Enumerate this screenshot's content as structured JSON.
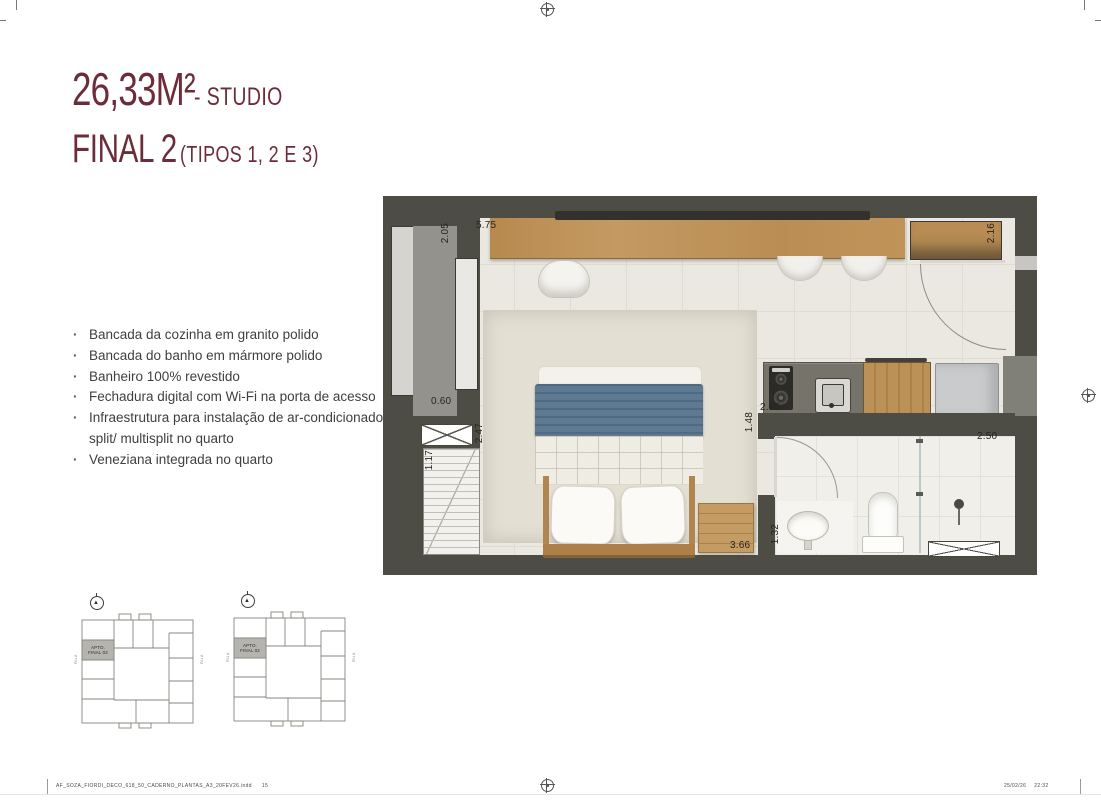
{
  "header": {
    "area": "26,33M²",
    "area_suffix": "- STUDIO",
    "unit": "FINAL 2",
    "unit_suffix": "(TIPOS 1, 2 E 3)",
    "accent_color": "#6d2c3a"
  },
  "features": [
    "Bancada da cozinha em granito polido",
    "Bancada do banho em mármore polido",
    "Banheiro 100% revestido",
    "Fechadura digital com Wi-Fi na porta de acesso",
    "Infraestrutura para instalação de ar-condicionado tipo split/ multisplit no quarto",
    "Veneziana integrada no quarto"
  ],
  "floorplan": {
    "wall_color": "#4e4d45",
    "wood_color": "#b98d54",
    "blanket_color": "#5e7a92",
    "dims": {
      "desk_width": "5.75",
      "window": "2.05",
      "upper_cabinet": "2.16",
      "niche": "0.60",
      "room_depth": "2.47",
      "wardrobe": "1.17",
      "kitchen": "2.65",
      "hall": "1.48",
      "bath": "1.32",
      "bed_wall": "3.66",
      "shower": "2.50"
    }
  },
  "keyplans": {
    "unit_line1": "APTO.",
    "unit_line2": "FINAL 02",
    "street_left": "RUA",
    "street_right": "RUA",
    "north_icon": "north-arrow-icon"
  },
  "footer": {
    "filename": "AF_SOZA_FIORDI_DECO_618_50_CADERNO_PLANTAS_A3_20FEV26.indd",
    "page": "15",
    "date": "25/02/26",
    "time": "22:32"
  }
}
